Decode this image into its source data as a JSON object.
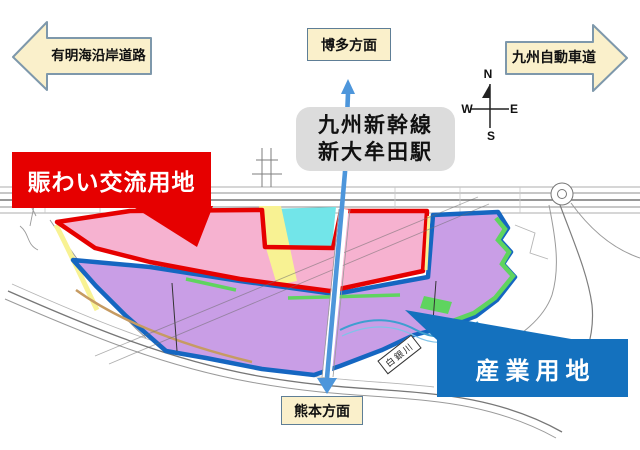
{
  "colors": {
    "red_accent": "#E60000",
    "blue_accent": "#1471BE",
    "pink_zone": "#F6B2D0",
    "purple_zone": "#C99EE6",
    "cyan_parcel": "#72E5E9",
    "yellow_strip": "#F8F293",
    "green_buffer": "#5FD45F",
    "blue_outline": "#1566C1",
    "shinkansen_blue": "#4D96DB",
    "arrow_fill": "#FAF0CB",
    "arrow_border": "#7E98AB",
    "box_border": "#5E7E96",
    "station_box_bg": "#DCDCDC",
    "tan_line": "#C69B62"
  },
  "directions": {
    "west_arrow": {
      "label": "有明海沿岸道路"
    },
    "north_box": {
      "label": "博多方面"
    },
    "east_arrow": {
      "label": "九州自動車道"
    },
    "south_box": {
      "label": "熊本方面"
    }
  },
  "station_callout": {
    "line1": "九州新幹線",
    "line2": "新大牟田駅"
  },
  "zone_callouts": {
    "exchange": {
      "label": "賑わい交流用地"
    },
    "industrial": {
      "label": "産業用地"
    }
  },
  "map": {
    "river_label": "白銀川"
  },
  "compass": {
    "n": "N",
    "e": "E",
    "s": "S",
    "w": "W"
  }
}
